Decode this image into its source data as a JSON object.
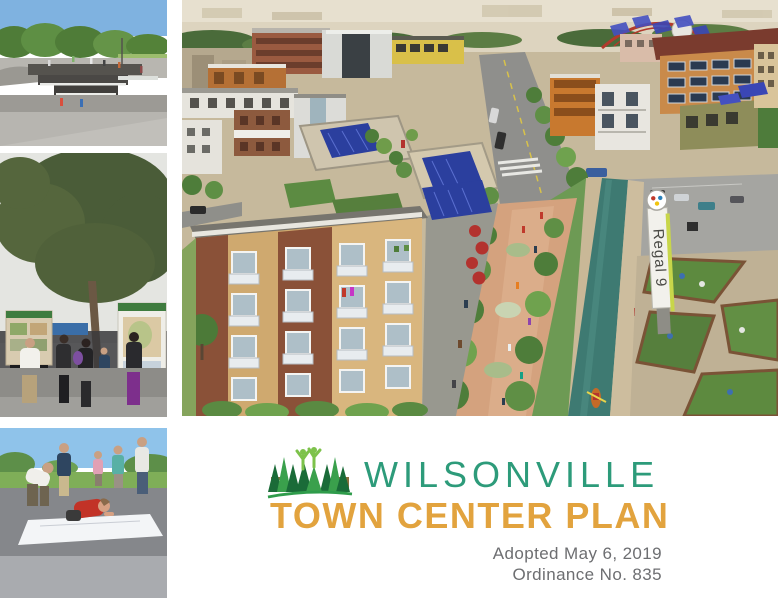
{
  "page": {
    "background": "#FFFFFF"
  },
  "branding": {
    "title_line1": "WILSONVILLE",
    "title_line2": "TOWN CENTER PLAN",
    "adopted_line1": "Adopted May 6, 2019",
    "adopted_line2": "Ordinance No. 835",
    "colors": {
      "title_line1_teal": "#2D9B7A",
      "title_line2_orange": "#E2A33E",
      "adopted_gray": "#6D6E71"
    },
    "logo": {
      "icon": "trees-people-buildings-logo",
      "colors": {
        "dark_green": "#1A6B38",
        "medium_green": "#3AA04C",
        "light_green": "#7DC24B",
        "building_brown": "#8A6D3B",
        "swoosh_green": "#2F9C4B"
      }
    }
  },
  "main_rendering": {
    "icon": "aerial-town-center-rendering",
    "regal_sign_text": "Regal 9",
    "accent_colors": {
      "solar_panel_blue": "#2B3F9E",
      "water_channel_teal": "#3E7A72",
      "promenade_brick": "#D4A27E",
      "umbrella_red": "#B3322E"
    }
  },
  "photos": [
    {
      "icon": "park-water-feature-photo"
    },
    {
      "icon": "community-open-house-photo"
    },
    {
      "icon": "kids-drawing-map-photo"
    }
  ]
}
